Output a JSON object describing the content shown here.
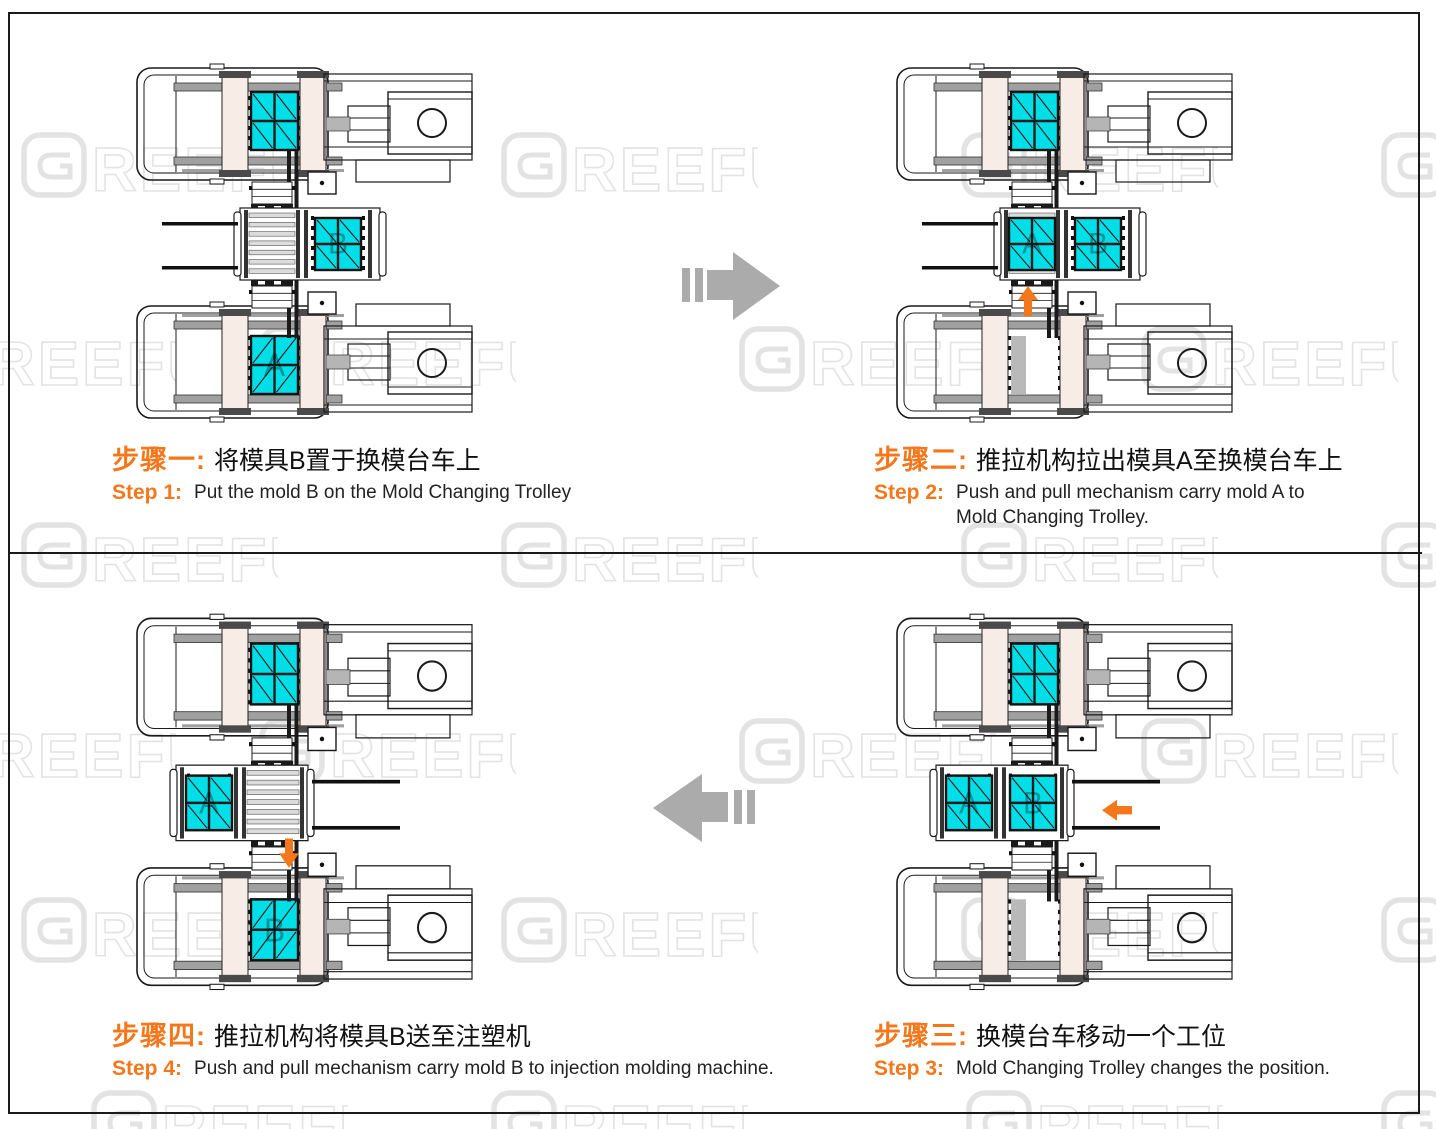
{
  "brand": {
    "watermark_text": "GREEFU"
  },
  "colors": {
    "accent_orange": "#F4771C",
    "mold_cyan": "#00DFE8",
    "platen_beige": "#F8ECE6",
    "machine_line": "#1A1A1A",
    "tie_bar_gray": "#A0A0A0",
    "part_gray": "#B5B5B5",
    "empty_slot_gray": "#B9B9B9",
    "flow_arrow_gray": "#ABABAB",
    "watermark_gray": "#E3E3E3",
    "background": "#FFFFFF"
  },
  "steps": [
    {
      "id": "step-1",
      "quadrant": "top-left",
      "zh_label": "步骤一:",
      "zh_title": "将模具B置于换模台车上",
      "en_label": "Step 1:",
      "en_line1": "Put the mold B on the Mold Changing Trolley",
      "en_line2": "",
      "diagram": {
        "machines": {
          "top_mold": true,
          "top_letter": "",
          "bottom_mold": true,
          "bottom_letter": "A"
        },
        "trolley": {
          "position": "station-1",
          "axis_mold": null,
          "side_mold": "B",
          "rails": "left"
        },
        "push_arrow": null
      }
    },
    {
      "id": "step-2",
      "quadrant": "top-right",
      "zh_label": "步骤二:",
      "zh_title": "推拉机构拉出模具A至换模台车上",
      "en_label": "Step 2:",
      "en_line1": "Push and pull mechanism carry mold A to",
      "en_line2": "Mold Changing Trolley.",
      "diagram": {
        "machines": {
          "top_mold": true,
          "top_letter": "",
          "bottom_mold": false,
          "bottom_letter": ""
        },
        "trolley": {
          "position": "station-1",
          "axis_mold": "A",
          "side_mold": "B",
          "rails": "left"
        },
        "push_arrow": "up"
      }
    },
    {
      "id": "step-3",
      "quadrant": "bottom-right",
      "zh_label": "步骤三:",
      "zh_title": "换模台车移动一个工位",
      "en_label": "Step 3:",
      "en_line1": "Mold Changing Trolley changes the position.",
      "en_line2": "",
      "diagram": {
        "machines": {
          "top_mold": true,
          "top_letter": "",
          "bottom_mold": false,
          "bottom_letter": ""
        },
        "trolley": {
          "position": "station-2",
          "axis_mold": "B",
          "side_mold": "A",
          "rails": "right"
        },
        "push_arrow": "left"
      }
    },
    {
      "id": "step-4",
      "quadrant": "bottom-left",
      "zh_label": "步骤四:",
      "zh_title": "推拉机构将模具B送至注塑机",
      "en_label": "Step 4:",
      "en_line1": "Push and pull mechanism carry mold B to injection molding machine.",
      "en_line2": "",
      "diagram": {
        "machines": {
          "top_mold": true,
          "top_letter": "",
          "bottom_mold": true,
          "bottom_letter": "B"
        },
        "trolley": {
          "position": "station-2",
          "axis_mold": null,
          "side_mold": "A",
          "rails": "right"
        },
        "push_arrow": "down"
      }
    }
  ],
  "flow_arrows": [
    {
      "id": "flow-step1-to-step2",
      "direction": "right"
    },
    {
      "id": "flow-step3-to-step4",
      "direction": "left"
    }
  ]
}
